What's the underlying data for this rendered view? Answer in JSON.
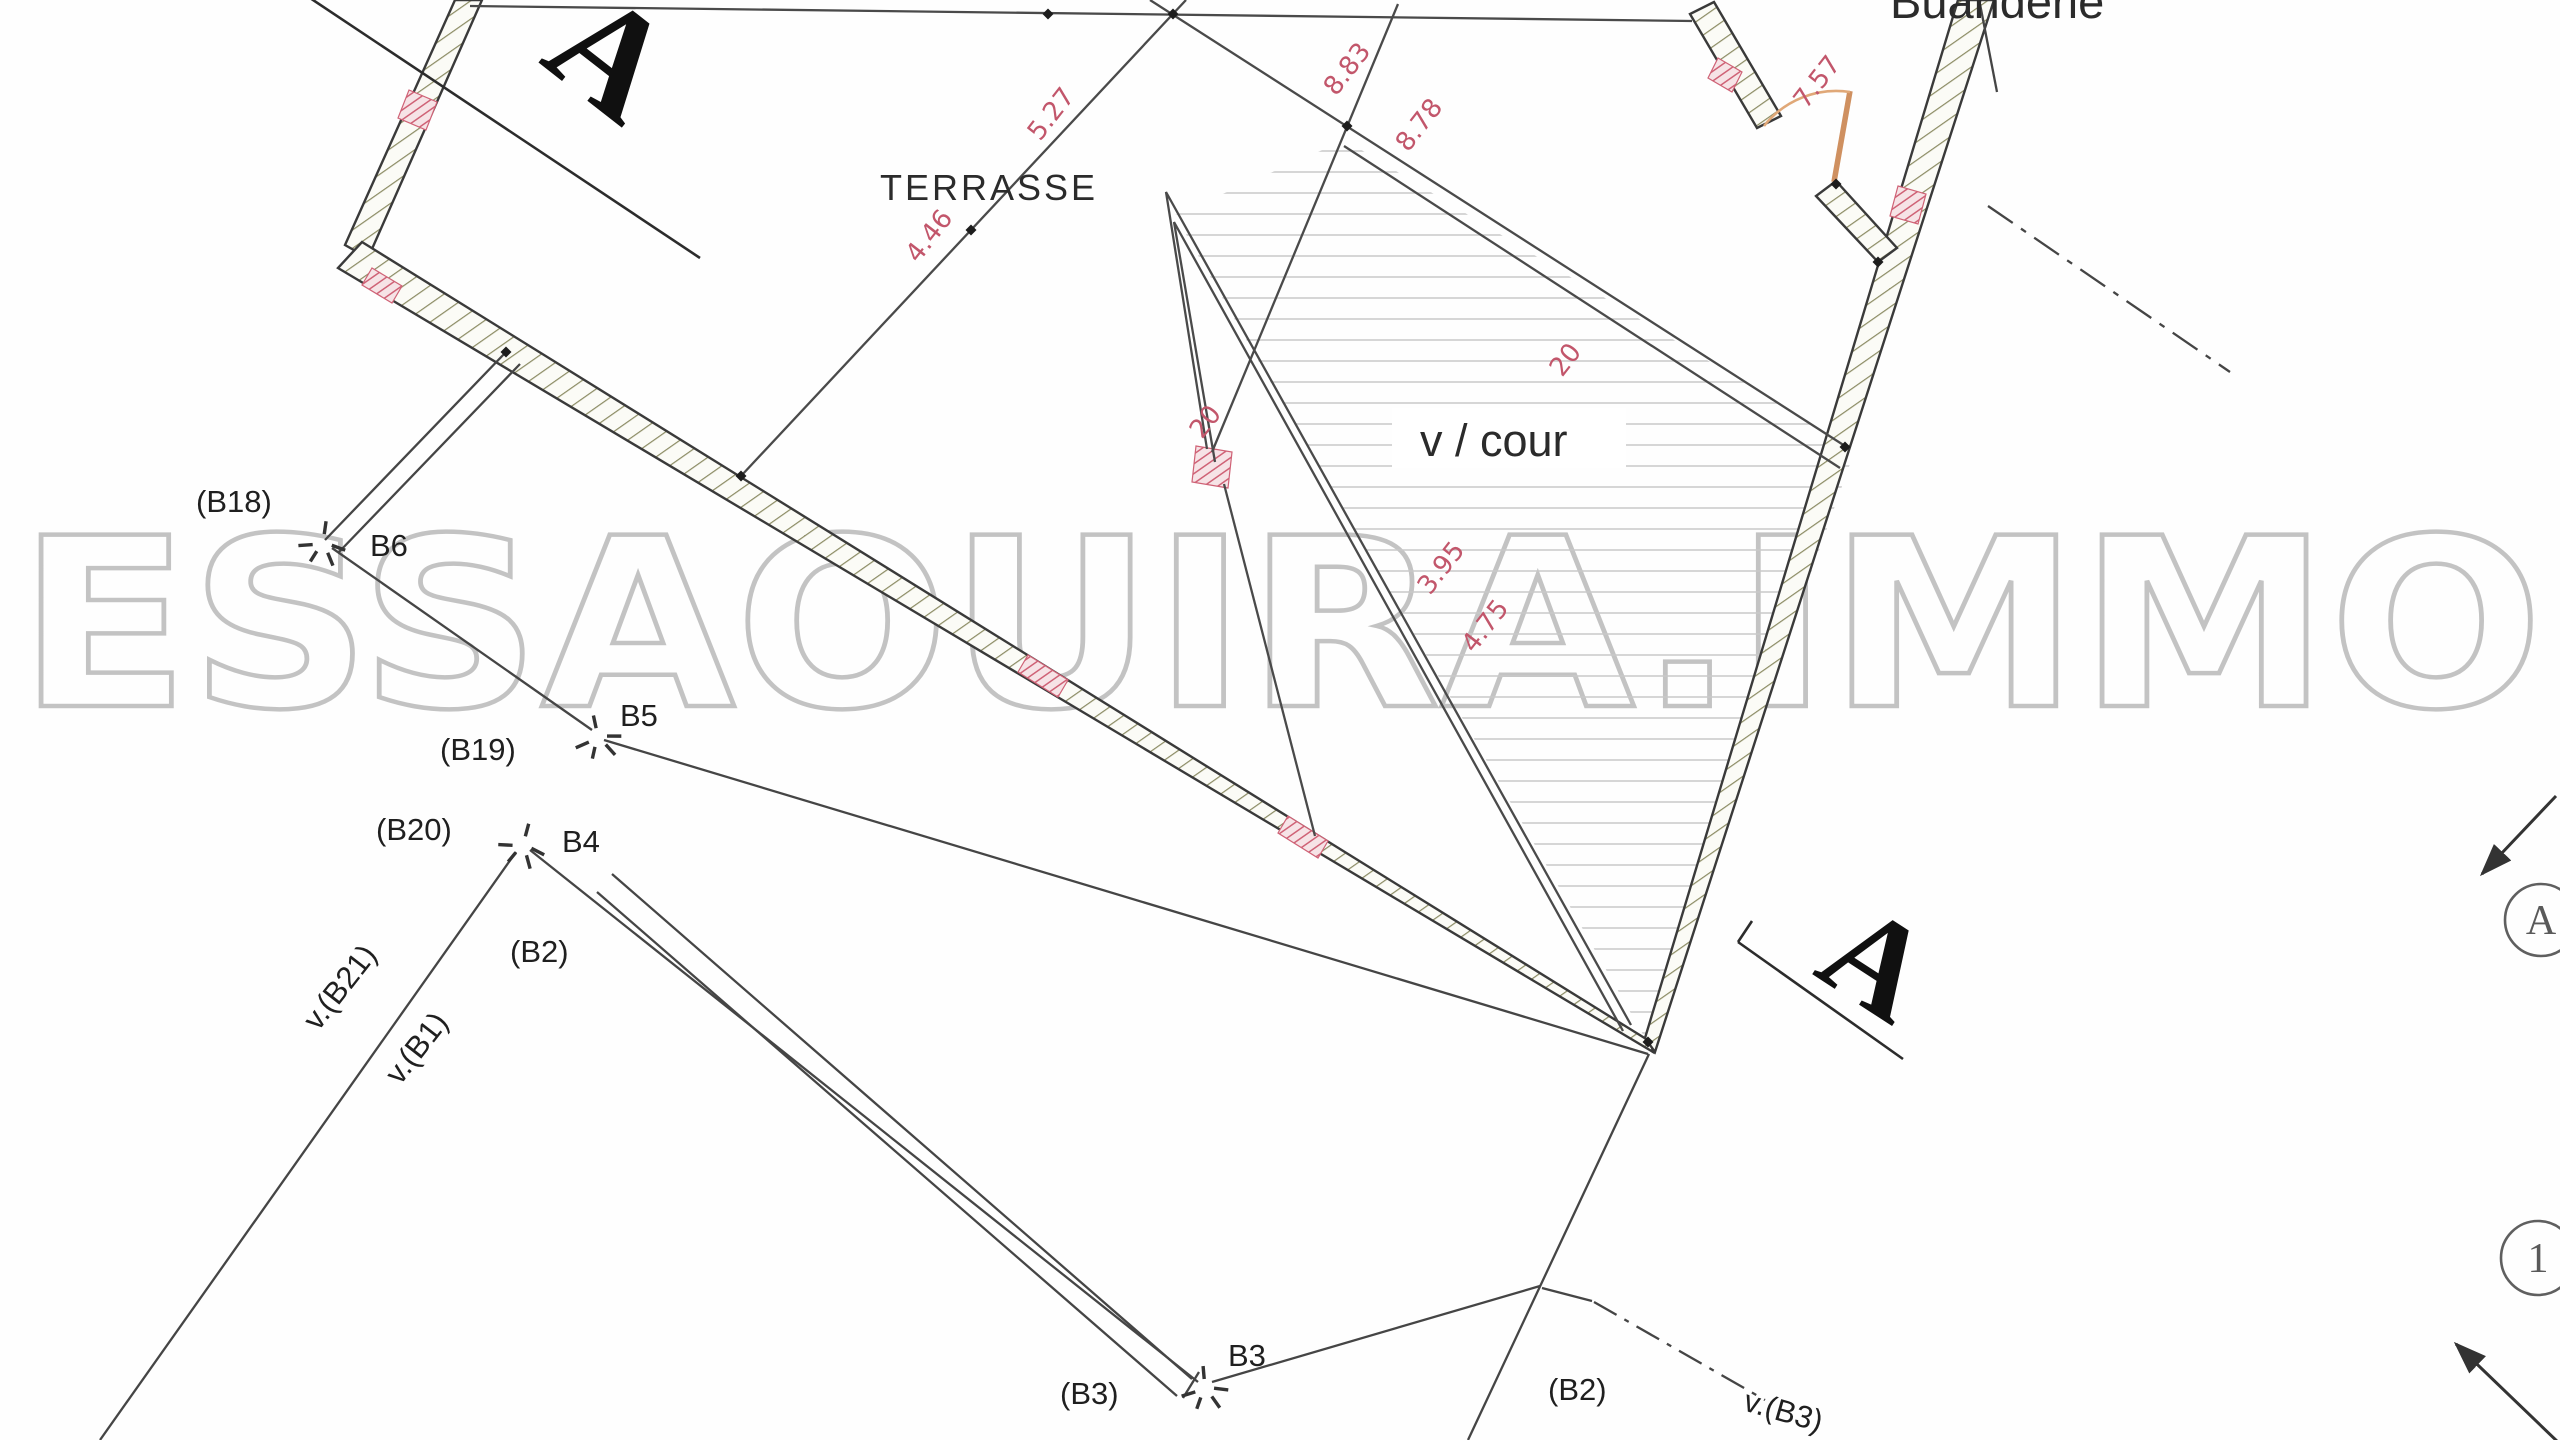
{
  "plan": {
    "watermark": "ESSAOUIRA.IMMO",
    "rooms": {
      "terrasse": "TERRASSE",
      "cour": "v / cour",
      "buanderie": "Buanderie"
    },
    "section_marks": {
      "top": "A",
      "bottom": "A"
    },
    "reference_circles": {
      "elevation": "A",
      "axis": "1"
    },
    "boundary_points": {
      "b18": "(B18)",
      "b6": "B6",
      "b19": "(B19)",
      "b5": "B5",
      "b20": "(B20)",
      "b4": "B4",
      "b2": "(B2)",
      "v_b21": "v.(B21)",
      "v_b1": "v.(B1)",
      "b3": "B3",
      "b3_p": "(B3)",
      "b2_bottom": "(B2)",
      "v_b3": "v.(B3)"
    },
    "dimensions": {
      "d1": "5.27",
      "d2": "4.46",
      "d3": "8.83",
      "d4": "8.78",
      "d5": "7.57",
      "d6": "20",
      "d7": "20",
      "d8": "3.95",
      "d9": "4.75"
    },
    "colors": {
      "dimension_red": "#c2566b",
      "wall_hatch_olive": "#8b8b63",
      "court_hatch_gray": "#c8c8c8",
      "watermark_gray": "#b5b5b5",
      "door_tan": "#d79b6b",
      "line_dark": "#3a3a3a"
    }
  }
}
